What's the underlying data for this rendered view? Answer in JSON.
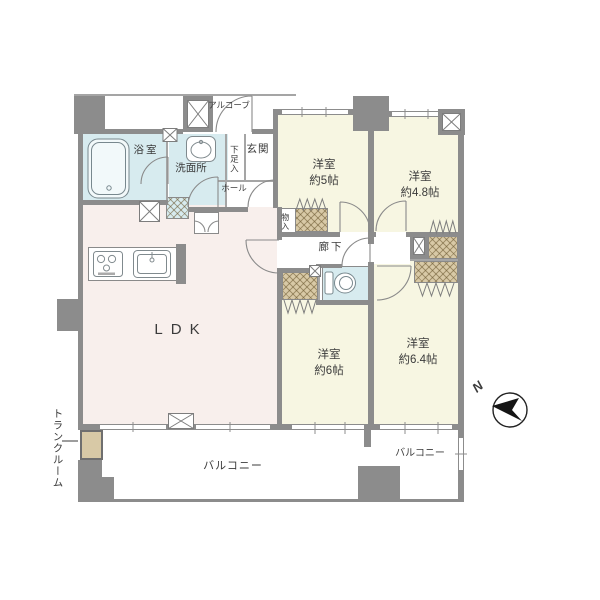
{
  "plan": {
    "labels": {
      "alcove": "アルコーブ",
      "bath": "浴室",
      "washroom": "洗面所",
      "shoe_cupboard": "下足入",
      "entrance": "玄関",
      "hall": "ホール",
      "closet_small": "物入",
      "corridor": "廊下",
      "ldk": "LDK",
      "bedroom_5": {
        "type": "洋室",
        "size": "約5帖"
      },
      "bedroom_48": {
        "type": "洋室",
        "size": "約4.8帖"
      },
      "bedroom_6": {
        "type": "洋室",
        "size": "約6帖"
      },
      "bedroom_64": {
        "type": "洋室",
        "size": "約6.4帖"
      },
      "balcony_main": "バルコニー",
      "balcony_sub": "バルコニー",
      "trunk_room": "トランクルーム"
    },
    "compass": {
      "north": "N"
    },
    "colors": {
      "wall": "#8c8c8c",
      "ldk_floor": "#f8efec",
      "bedroom_floor": "#f7f6e2",
      "wet_area_floor": "#d7ebef",
      "closet": "#d8c9a6",
      "outline": "#9a9a9a"
    }
  }
}
